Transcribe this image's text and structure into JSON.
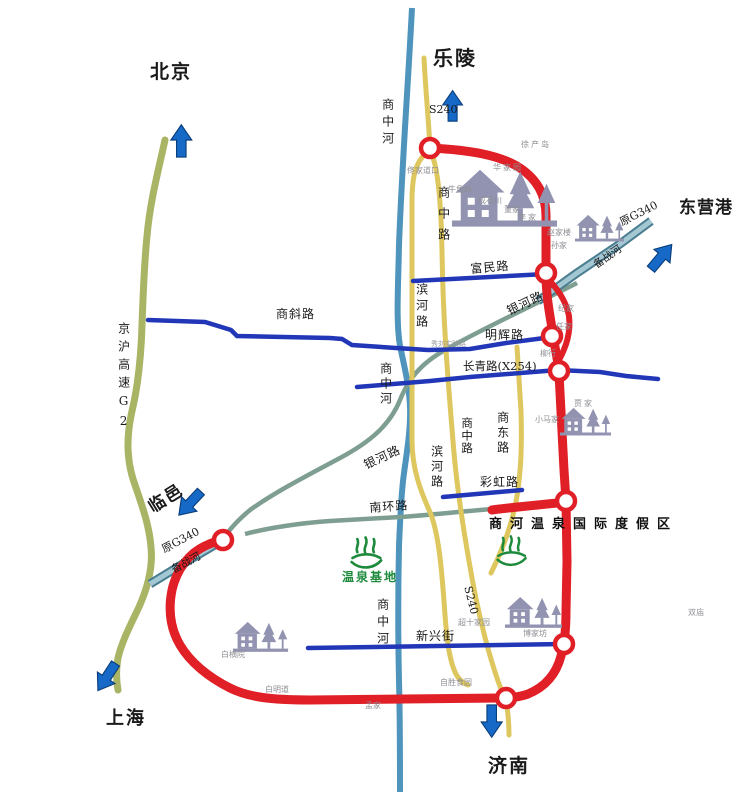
{
  "cities": {
    "beijing": "北京",
    "shanghai": "上海",
    "leling": "乐陵",
    "dongying_port": "东营港",
    "linyi": "临邑",
    "jinan": "济南"
  },
  "highways": {
    "jinghu_g2": "京沪高速G2",
    "former_g340": "原G340",
    "s240": "S240"
  },
  "rivers": {
    "shangzhong_river": "商中河",
    "beizhan_river": "备战河"
  },
  "streets": {
    "shangzhong_road": "商中路",
    "binhe_road": "滨河路",
    "shangdong_road": "商东路",
    "fumin_road": "富民路",
    "shangxie_road": "商斜路",
    "minghui_road": "明辉路",
    "changqing_road": "长青路(X254)",
    "yinhe_road": "银河路",
    "nanhuan_road": "南环路",
    "caihong_road": "彩虹路",
    "xinxing_street": "新兴街",
    "xiuliu_lane": "秀刘实践路"
  },
  "resort": {
    "name": "商河温泉国际度假区",
    "spring_base": "温泉基地"
  },
  "villages": {
    "tongjiadaokou": "佟家道口",
    "niujiaofeng": "牛角峰",
    "chengshichuan": "成石川",
    "huajiayuan": "华家园",
    "dongjia": "董家",
    "lijia": "李家",
    "xuchandao": "徐产岛",
    "zhaojialou": "赵家楼",
    "sunjia": "孙家",
    "jijia": "纪家",
    "renjia": "任家",
    "liuhang": "柳行",
    "xiaomajia": "小马家",
    "jiajia": "贾家",
    "shuangmiao": "双庙",
    "chaoshijiayuan": "超十家园",
    "bojiafang": "博家坊",
    "zishengshiyuan": "自胜食园",
    "baimingdao": "白明道",
    "mengjia": "孟家",
    "baihengyuan": "白横院"
  },
  "colors": {
    "ring_red": "#e01f26",
    "street_blue": "#2137b8",
    "road_yellow": "#ddc75e",
    "river_teal": "#4e94bc",
    "g340_light": "#a3c8d4",
    "g340_dark": "#4a7d90",
    "road_sage": "#7f9e92",
    "g2_olive": "#a9b464",
    "arrow_blue": "#1769c8",
    "building_gray": "#9193b0",
    "spring_green": "#1e8a3c"
  }
}
